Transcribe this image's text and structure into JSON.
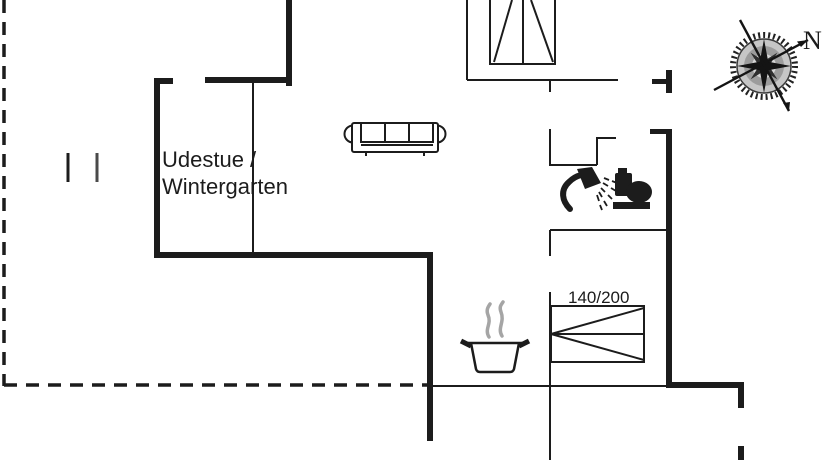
{
  "floor_plan": {
    "room_label": {
      "line1": "Udestue /",
      "line2": "Wintergarten"
    },
    "bed": {
      "size_label": "140/200"
    },
    "compass": {
      "north_label": "N"
    },
    "colors": {
      "ink": "#1c1c1c",
      "steam_gray": "#a5a5a5",
      "background": "#ffffff"
    },
    "icons": [
      {
        "name": "window-icon",
        "meaning": "casement window"
      },
      {
        "name": "sofa-icon",
        "meaning": "three-seat sofa"
      },
      {
        "name": "shower-icon",
        "meaning": "shower head"
      },
      {
        "name": "toilet-icon",
        "meaning": "toilet"
      },
      {
        "name": "bed-icon",
        "meaning": "double bed 140/200"
      },
      {
        "name": "cooking-pot-icon",
        "meaning": "kitchen / stove pot"
      },
      {
        "name": "steam-icon",
        "meaning": "steam above pot"
      },
      {
        "name": "compass-rose-icon",
        "meaning": "north orientation compass"
      }
    ]
  }
}
